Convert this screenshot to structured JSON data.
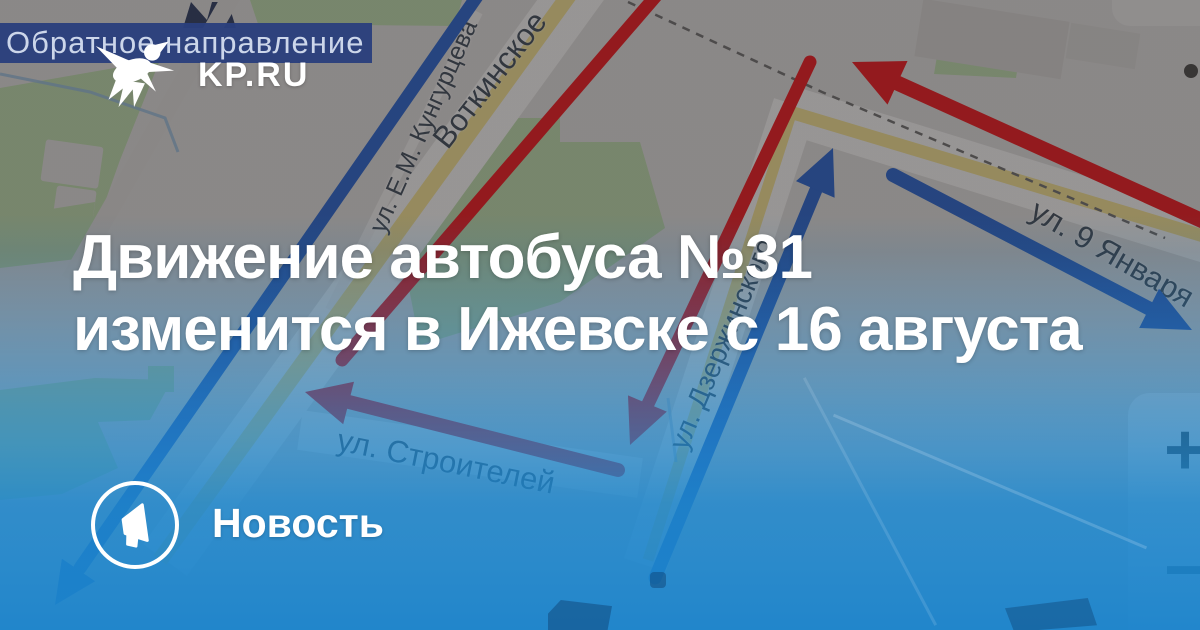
{
  "site": {
    "logo_text": "KP.RU",
    "logo_icon": "kp-swallow"
  },
  "legend_banner": {
    "text": "Обратное направление"
  },
  "headline": {
    "line1": "Движение автобуса №31",
    "line2": "изменится в Ижевске с 16 августа"
  },
  "badge": {
    "label": "Новость",
    "icon": "megaphone-icon"
  },
  "map": {
    "street_labels": [
      {
        "text": "ул. Е.М. Кунгурцева"
      },
      {
        "text": "Воткинское"
      },
      {
        "text": "ул. Дзержинского"
      },
      {
        "text": "ул. Строителей"
      },
      {
        "text": "ул. 9 Января"
      }
    ],
    "controls": {
      "zoom_in": "+",
      "zoom_out": "−"
    },
    "route_colors": {
      "direction_a": "#e8191c",
      "direction_b": "#2b62c4"
    }
  },
  "colors": {
    "overlay_blue": "#1b82c6",
    "banner_navy": "#2b3f7d",
    "map_green": "#b8d3a4",
    "map_road_yellow": "#ecd98a"
  }
}
